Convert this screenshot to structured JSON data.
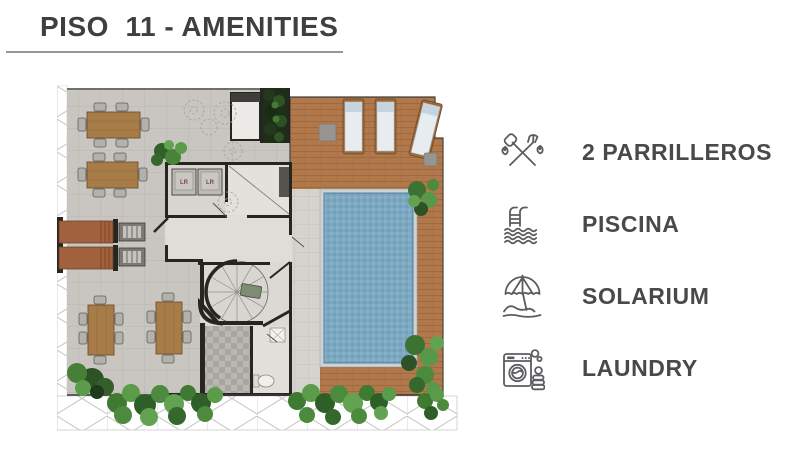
{
  "header": {
    "title": "PISO  11 - AMENITIES"
  },
  "legend": {
    "items": [
      {
        "icon": "grill-tools-icon",
        "label": "2 PARRILLEROS"
      },
      {
        "icon": "pool-ladder-icon",
        "label": "PISCINA"
      },
      {
        "icon": "beach-umbrella-icon",
        "label": "SOLARIUM"
      },
      {
        "icon": "washing-machine-icon",
        "label": "LAUNDRY"
      }
    ]
  },
  "floor_plan": {
    "machine_labels": [
      "LR",
      "LR"
    ]
  },
  "colors": {
    "title_text": "#3e3f41",
    "title_underline": "#97979b",
    "legend_text": "#48494b",
    "icon_stroke": "#5c5d60",
    "terrace_tile": "#c9c6c2",
    "deck_wood": "#b1794b",
    "pool_water": "#7ca8c2",
    "wall": "#26251f",
    "greenery": "#4c8a3e"
  }
}
